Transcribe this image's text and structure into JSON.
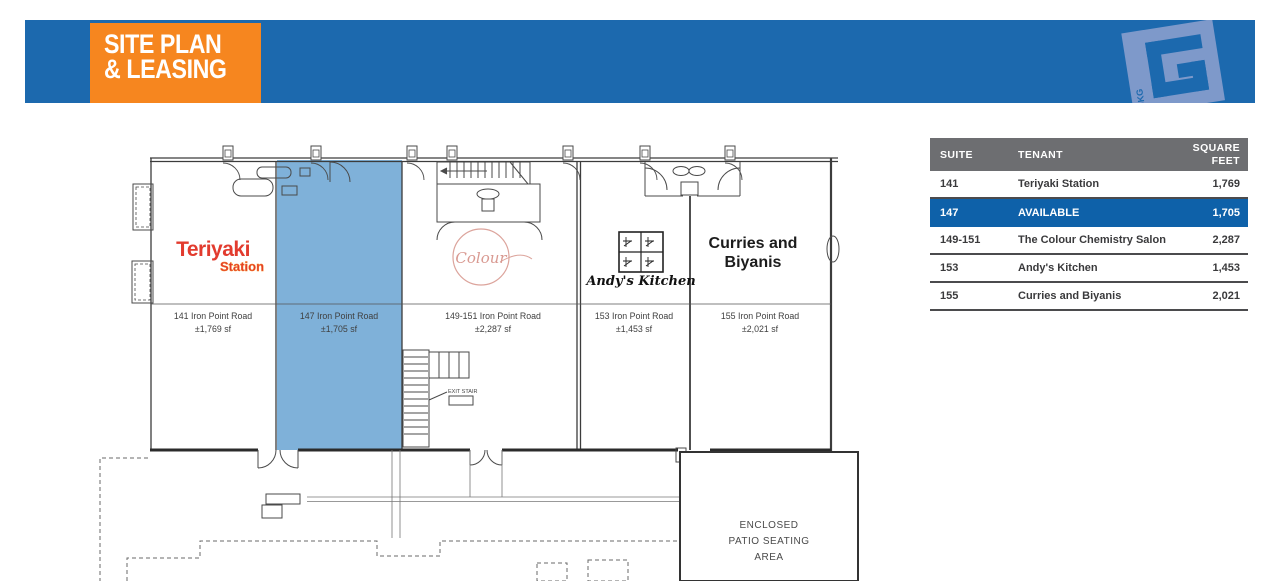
{
  "banner": {
    "title_line1": "SITE PLAN",
    "title_line2": "& LEASING",
    "logo_letter": "G",
    "logo_text": "JKG"
  },
  "plan": {
    "suites": [
      {
        "suite": "141",
        "address": "141 Iron Point Road",
        "area": "±1,769 sf"
      },
      {
        "suite": "147",
        "address": "147 Iron Point Road",
        "area": "±1,705 sf"
      },
      {
        "suite": "149-151",
        "address": "149-151 Iron Point Road",
        "area": "±2,287 sf"
      },
      {
        "suite": "153",
        "address": "153 Iron Point Road",
        "area": "±1,453 sf"
      },
      {
        "suite": "155",
        "address": "155 Iron Point Road",
        "area": "±2,021 sf"
      }
    ],
    "logos": {
      "teriyaki_1": "Teriyaki",
      "teriyaki_2": "Station",
      "colour": "Colour",
      "andys": "Andy's Kitchen",
      "curries_1": "Curries and",
      "curries_2": "Biyanis"
    },
    "exit_stair_label": "EXIT STAIR",
    "patio": [
      "ENCLOSED",
      "PATIO SEATING",
      "AREA"
    ]
  },
  "table": {
    "headers": {
      "suite": "SUITE",
      "tenant": "TENANT",
      "sqft": "SQUARE FEET"
    },
    "rows": [
      {
        "suite": "141",
        "tenant": "Teriyaki Station",
        "sqft": "1,769",
        "highlight": false
      },
      {
        "suite": "147",
        "tenant": "AVAILABLE",
        "sqft": "1,705",
        "highlight": true
      },
      {
        "suite": "149-151",
        "tenant": "The Colour Chemistry Salon",
        "sqft": "2,287",
        "highlight": false
      },
      {
        "suite": "153",
        "tenant": "Andy's Kitchen",
        "sqft": "1,453",
        "highlight": false
      },
      {
        "suite": "155",
        "tenant": "Curries and Biyanis",
        "sqft": "2,021",
        "highlight": false
      }
    ]
  },
  "colors": {
    "banner_blue": "#1C69AE",
    "accent_orange": "#F6861F",
    "logo_light_blue": "#7E99CA",
    "suite_highlight_blue": "#7FB1D9",
    "table_row_blue": "#0E61A9",
    "table_header_gray": "#6D6E71",
    "teriyaki_red": "#E23B2E",
    "colour_salmon": "#DCA49C"
  }
}
